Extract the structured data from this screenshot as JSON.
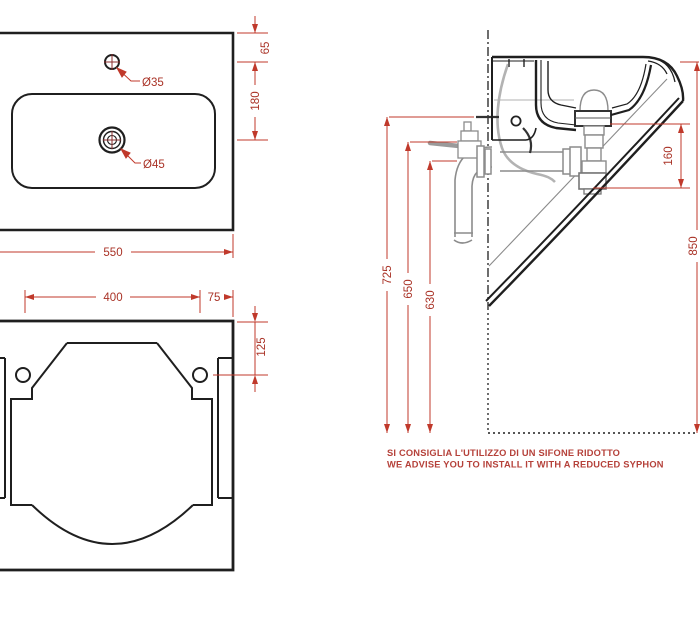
{
  "drawing_title": "wall-hung washbasin technical drawing",
  "colors": {
    "object_line": "#1f1f1f",
    "hardware_gray": "#8c8c8c",
    "dimension_red": "#c0392b",
    "dimension_text_red": "#a93226",
    "note_red": "#b5413a"
  },
  "top_view": {
    "dim_width": "550",
    "dim_hole_offset": "65",
    "dim_hole_spacing": "180",
    "label_faucet_hole": "Ø35",
    "label_drain_hole": "Ø45"
  },
  "front_view": {
    "dim_fixing_spacing": "400",
    "dim_fixing_edge": "75",
    "dim_fixing_depth": "125"
  },
  "side_view": {
    "dim_height_725": "725",
    "dim_height_650": "650",
    "dim_height_630": "630",
    "dim_drain_offset": "160",
    "dim_height_850": "850"
  },
  "note": {
    "line1_it": "SI CONSIGLIA L'UTILIZZO DI UN SIFONE RIDOTTO",
    "line2_en": "WE ADVISE YOU TO INSTALL IT WITH A REDUCED SYPHON"
  }
}
